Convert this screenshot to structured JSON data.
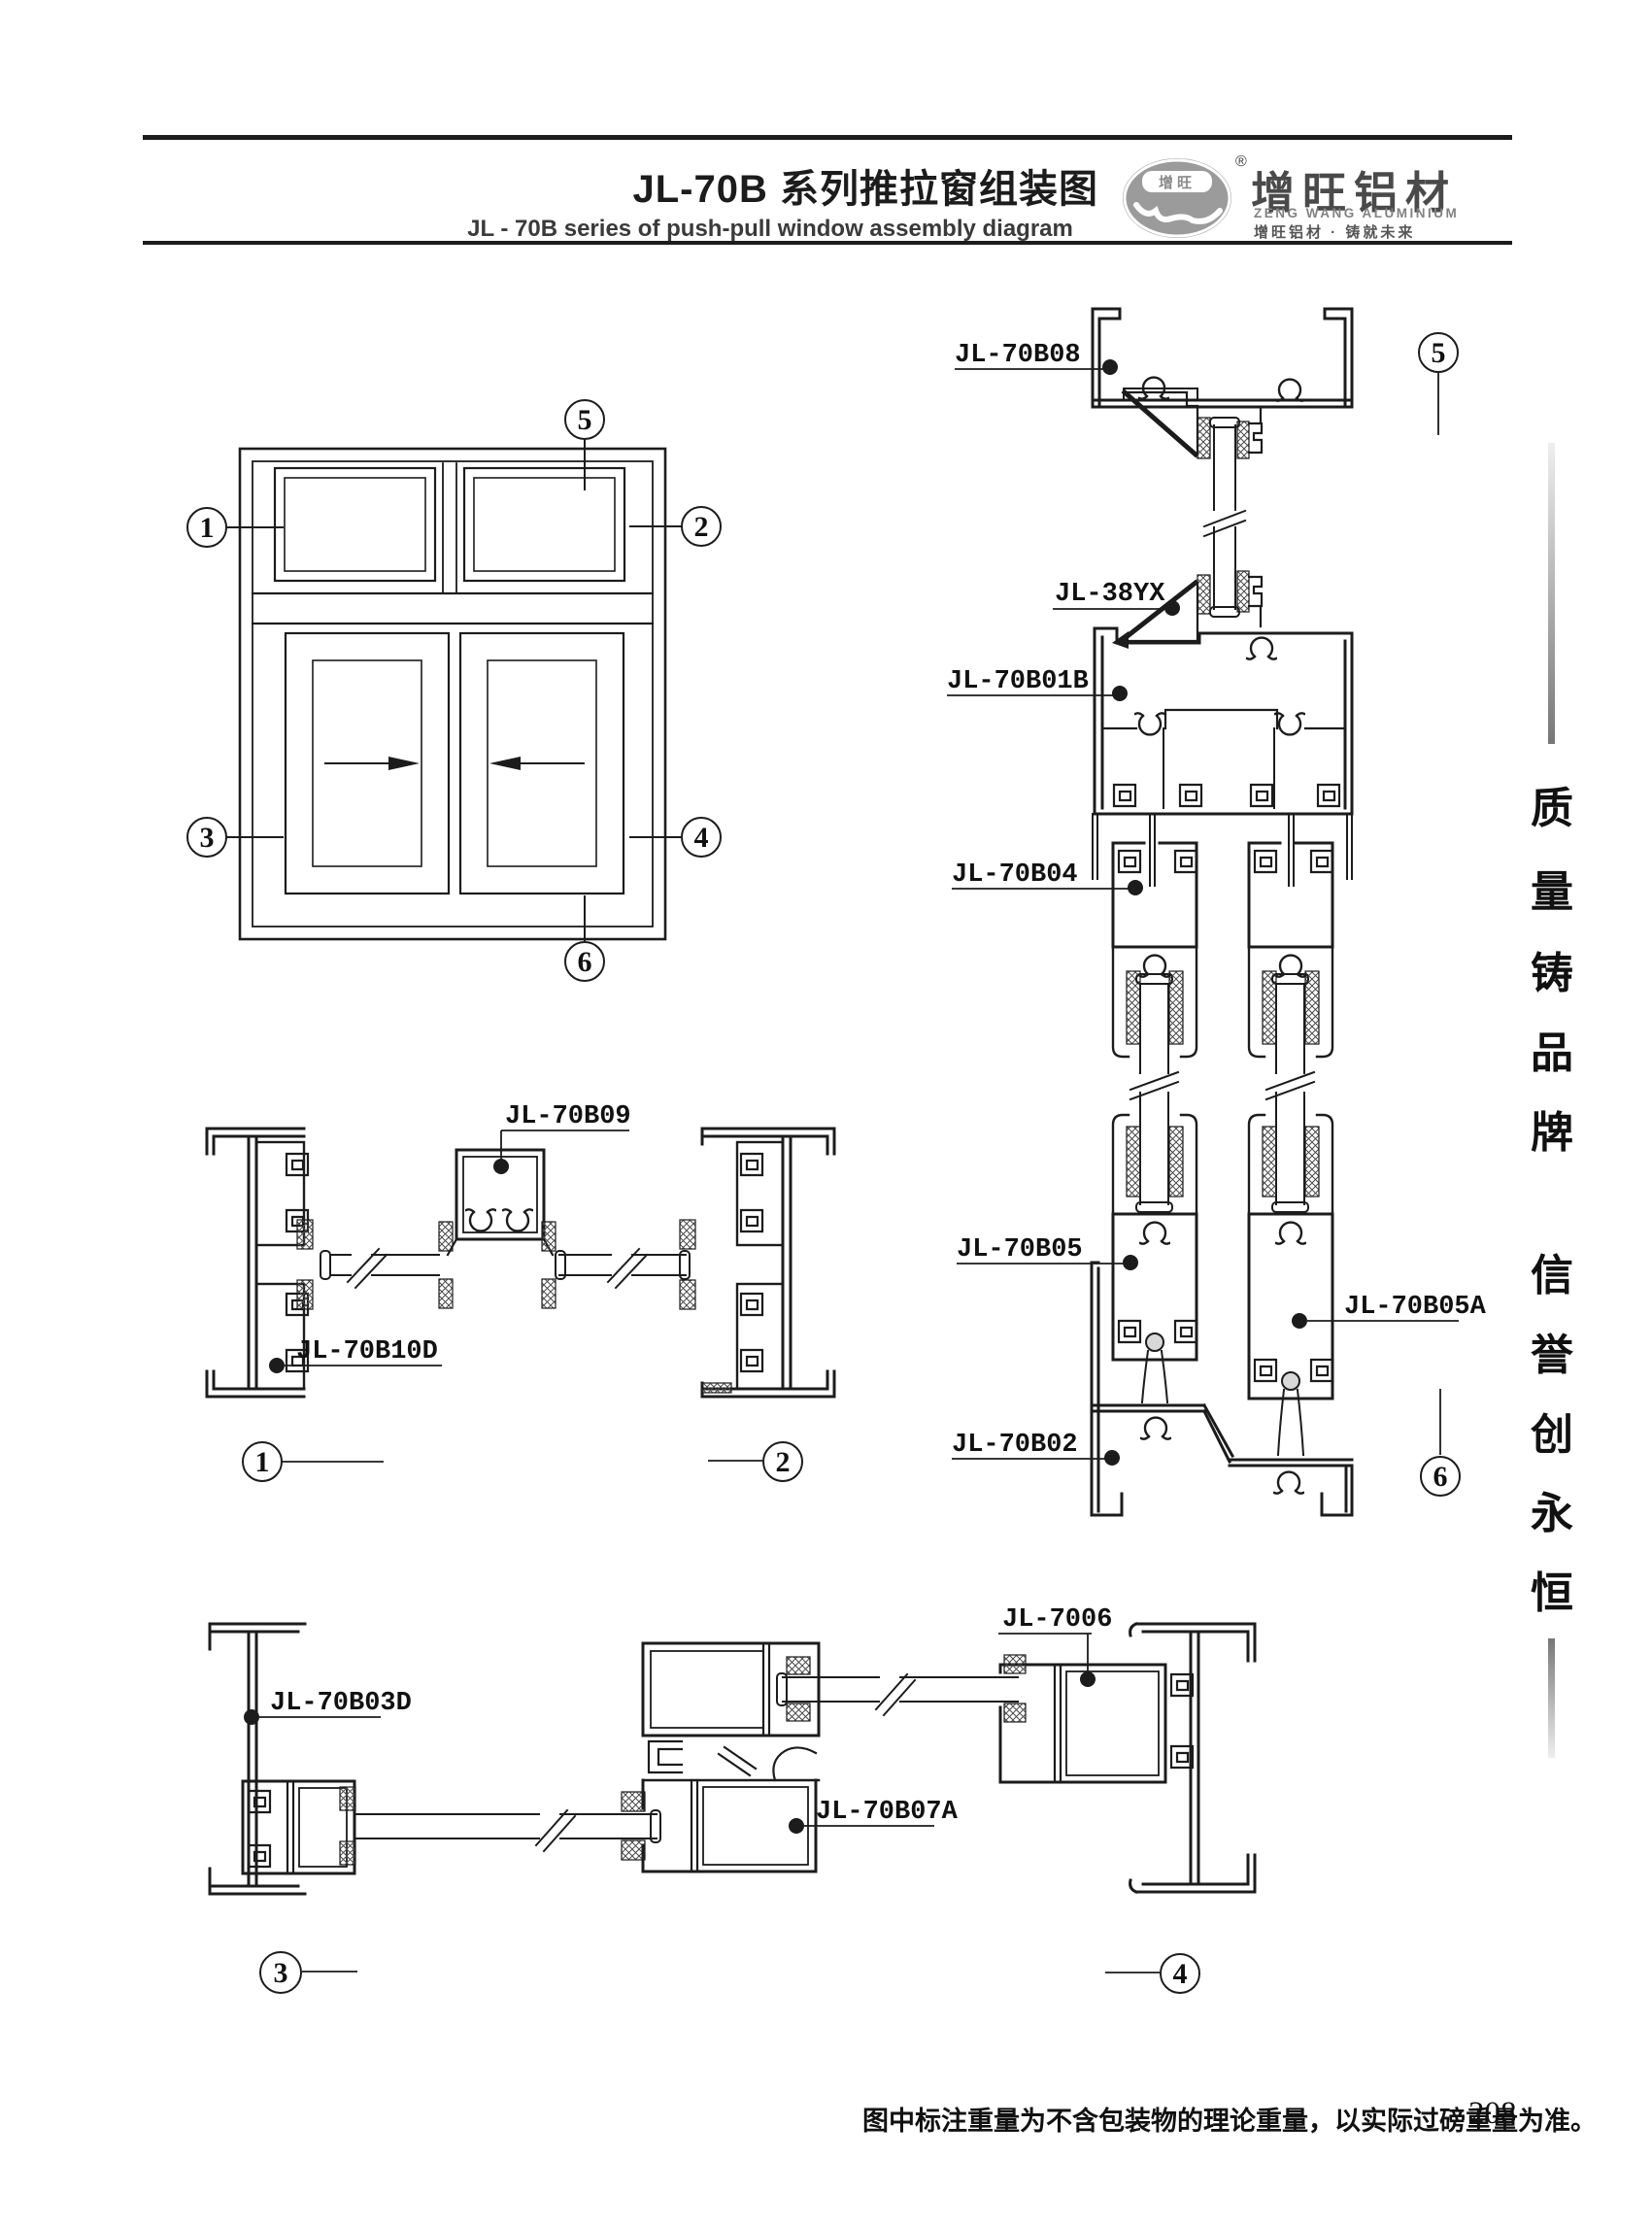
{
  "header": {
    "title_zh": "JL-70B 系列推拉窗组装图",
    "title_en": "JL - 70B series of push-pull window assembly diagram",
    "logo": {
      "badge": "增旺",
      "registered": "®",
      "brand_zh": "增旺铝材",
      "brand_en": "ZENG WANG ALUMINIUM",
      "tagline": "增旺铝材 · 铸就未来"
    }
  },
  "slogan": {
    "text": "质量铸品牌 信誉创永恒",
    "chars": [
      "质",
      "量",
      "铸",
      "品",
      "牌",
      "信",
      "誉",
      "创",
      "永",
      "恒"
    ]
  },
  "labels": {
    "b08": "JL-70B08",
    "yx": "JL-38YX",
    "b01b": "JL-70B01B",
    "b04": "JL-70B04",
    "b05": "JL-70B05",
    "b05a": "JL-70B05A",
    "b02": "JL-70B02",
    "b09": "JL-70B09",
    "b10d": "JL-70B10D",
    "b03d": "JL-70B03D",
    "b7006": "JL-7006",
    "b07a": "JL-70B07A"
  },
  "callouts": {
    "n1": "1",
    "n2": "2",
    "n3": "3",
    "n4": "4",
    "n5": "5",
    "n6": "6"
  },
  "footer": {
    "note": "图中标注重量为不含包装物的理论重量，以实际过磅重量为准。",
    "page_number": "208"
  }
}
